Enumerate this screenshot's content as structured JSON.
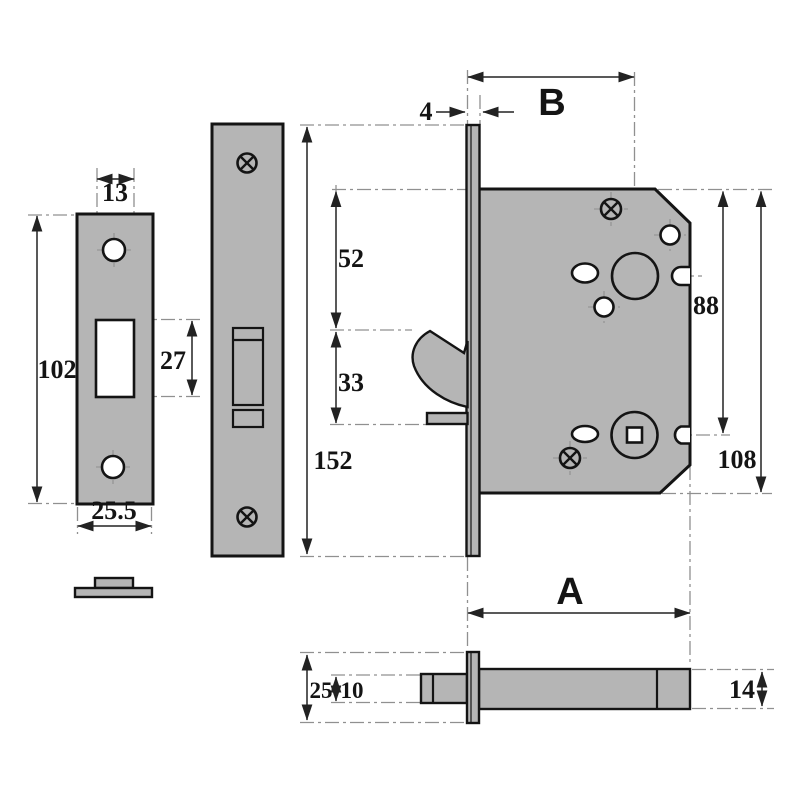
{
  "dims": {
    "slot_width": "13",
    "plate_height": "102",
    "slot_height": "27",
    "plate_width": "25.5",
    "forend_height": "152",
    "faceplate_thickness": "4",
    "backset": "B",
    "top_to_hook": "52",
    "hook_opening": "33",
    "top_to_spindle": "88",
    "case_height": "108",
    "case_depth": "A",
    "edge_overall": "25",
    "edge_stub": "10",
    "edge_thickness": "14"
  },
  "colors": {
    "part_fill": "#b5b5b5",
    "outline": "#141414",
    "dim_line": "#222222",
    "centerline": "#909090",
    "hole_fill": "#ffffff",
    "background": "#ffffff"
  }
}
